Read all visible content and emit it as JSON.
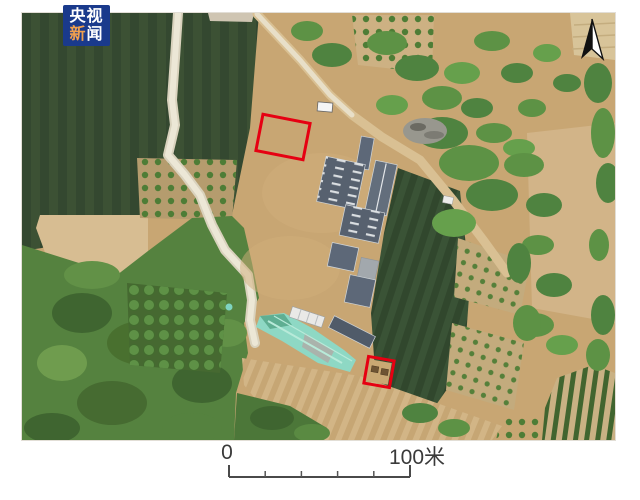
{
  "logo": {
    "line1": "央视",
    "line2_char1": "新",
    "line2_char2": "闻",
    "background_color": "#1a3a8c",
    "accent_color": "#f0a04e",
    "text_color": "#ffffff"
  },
  "scale_bar": {
    "start_label": "0",
    "end_label": "100米"
  },
  "map": {
    "kind": "aerial-drone-photo-of-farm-compound",
    "north_arrow": "present-top-right",
    "red_marker_color": "#e60012",
    "red_marker_count": 2
  }
}
